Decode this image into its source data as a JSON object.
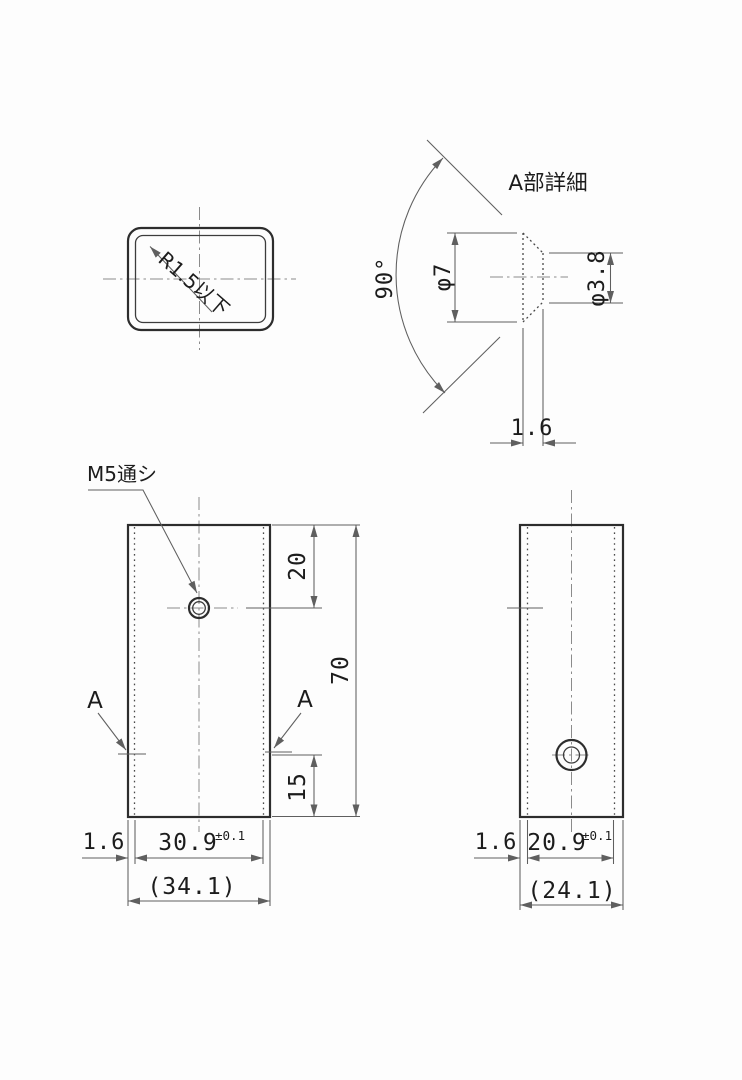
{
  "labels": {
    "section_view": {
      "radius_note": "R1.5以下"
    },
    "detail_view": {
      "title": "A部詳細",
      "angle": "90°",
      "mouth_dia": "φ7",
      "hole_dia": "φ3.8",
      "wall": "1.6"
    },
    "front_view": {
      "thread_note": "M5通シ",
      "section_a_left": "A",
      "section_a_right": "A",
      "hole_from_top": "20",
      "total_height": "70",
      "countersink_from_bottom": "15",
      "wall": "1.6",
      "inner_width": "30.9",
      "inner_width_tol": "±0.1",
      "outer_width": "(34.1)"
    },
    "side_view": {
      "wall": "1.6",
      "inner_depth": "20.9",
      "inner_depth_tol": "±0.1",
      "outer_depth": "(24.1)"
    }
  },
  "colors": {
    "object_line": "#2d2d2d",
    "dimension_line": "#5f5f5f",
    "centerline": "#8b8b8b",
    "background": "#fdfdfd"
  }
}
